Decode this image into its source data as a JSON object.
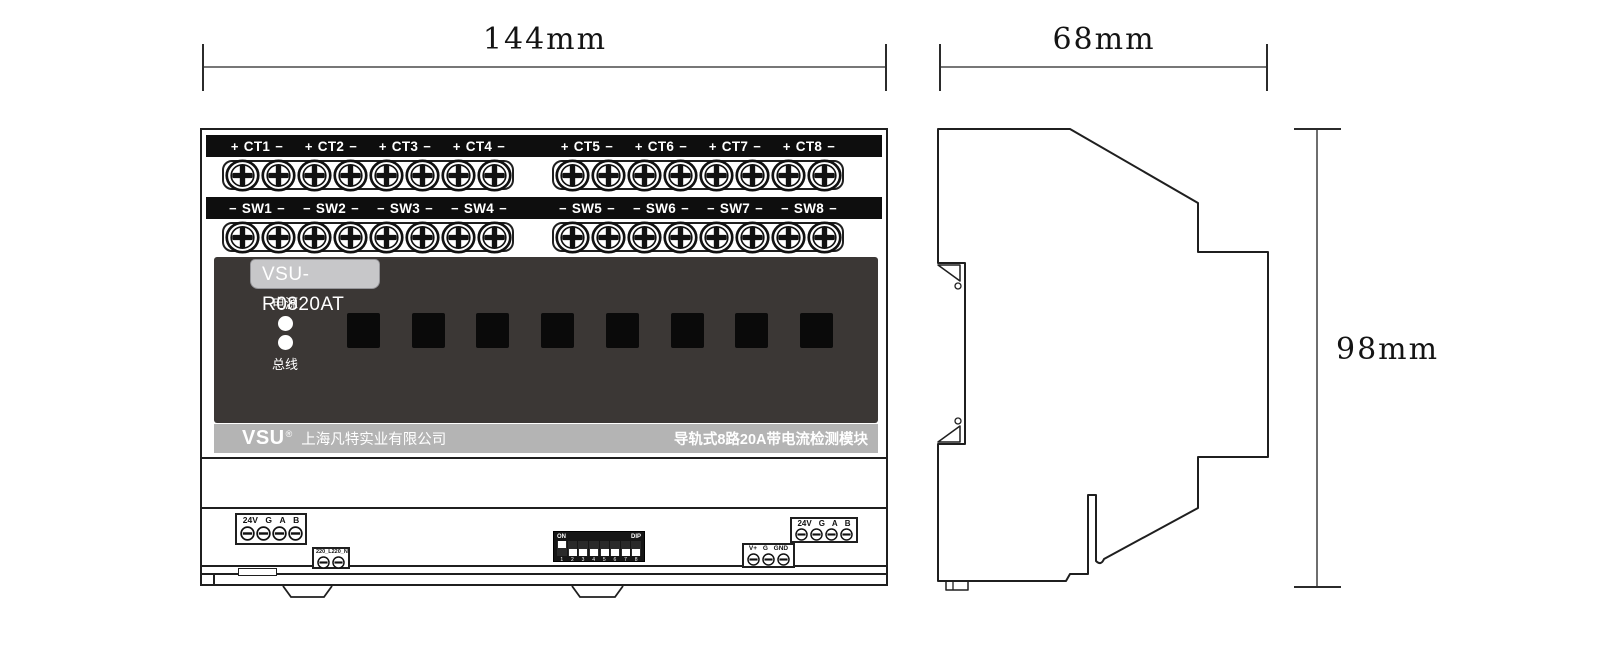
{
  "dimensions": {
    "front_width": "144mm",
    "side_width": "68mm",
    "height": "98mm"
  },
  "front_view": {
    "ct_row": {
      "channels": [
        {
          "prefix": "+",
          "label": "CT1",
          "suffix": "−"
        },
        {
          "prefix": "+",
          "label": "CT2",
          "suffix": "−"
        },
        {
          "prefix": "+",
          "label": "CT3",
          "suffix": "−"
        },
        {
          "prefix": "+",
          "label": "CT4",
          "suffix": "−"
        },
        {
          "prefix": "+",
          "label": "CT5",
          "suffix": "−"
        },
        {
          "prefix": "+",
          "label": "CT6",
          "suffix": "−"
        },
        {
          "prefix": "+",
          "label": "CT7",
          "suffix": "−"
        },
        {
          "prefix": "+",
          "label": "CT8",
          "suffix": "−"
        }
      ]
    },
    "sw_row": {
      "channels": [
        {
          "prefix": "−",
          "label": "SW1",
          "suffix": "−"
        },
        {
          "prefix": "−",
          "label": "SW2",
          "suffix": "−"
        },
        {
          "prefix": "−",
          "label": "SW3",
          "suffix": "−"
        },
        {
          "prefix": "−",
          "label": "SW4",
          "suffix": "−"
        },
        {
          "prefix": "−",
          "label": "SW5",
          "suffix": "−"
        },
        {
          "prefix": "−",
          "label": "SW6",
          "suffix": "−"
        },
        {
          "prefix": "−",
          "label": "SW7",
          "suffix": "−"
        },
        {
          "prefix": "−",
          "label": "SW8",
          "suffix": "−"
        }
      ]
    },
    "screw_terminals_per_group": 8,
    "panel": {
      "model": "VSU-R0820AT",
      "power_led_label": "电源",
      "bus_led_label": "总线",
      "channel_windows": 8,
      "panel_color": "#3b3735"
    },
    "brand_bar": {
      "logo": "VSU",
      "registered": "®",
      "company": "上海凡特实业有限公司",
      "product": "导轨式8路20A带电流检测模块",
      "bar_color": "#b4b4b4"
    },
    "bottom": {
      "left_power": {
        "labels": [
          "24V",
          "G",
          "A",
          "B"
        ]
      },
      "ac_input": {
        "labels": [
          "220_L",
          "220_N"
        ]
      },
      "dip": {
        "on_label": "ON",
        "dip_label": "DIP",
        "numbers": [
          "1",
          "2",
          "3",
          "4",
          "5",
          "6",
          "7",
          "8"
        ],
        "positions": [
          "up",
          "down",
          "down",
          "down",
          "down",
          "down",
          "down",
          "down"
        ]
      },
      "aux_power": {
        "labels": [
          "V+",
          "G",
          "GND"
        ]
      },
      "right_power": {
        "labels": [
          "24V",
          "G",
          "A",
          "B"
        ]
      }
    }
  }
}
